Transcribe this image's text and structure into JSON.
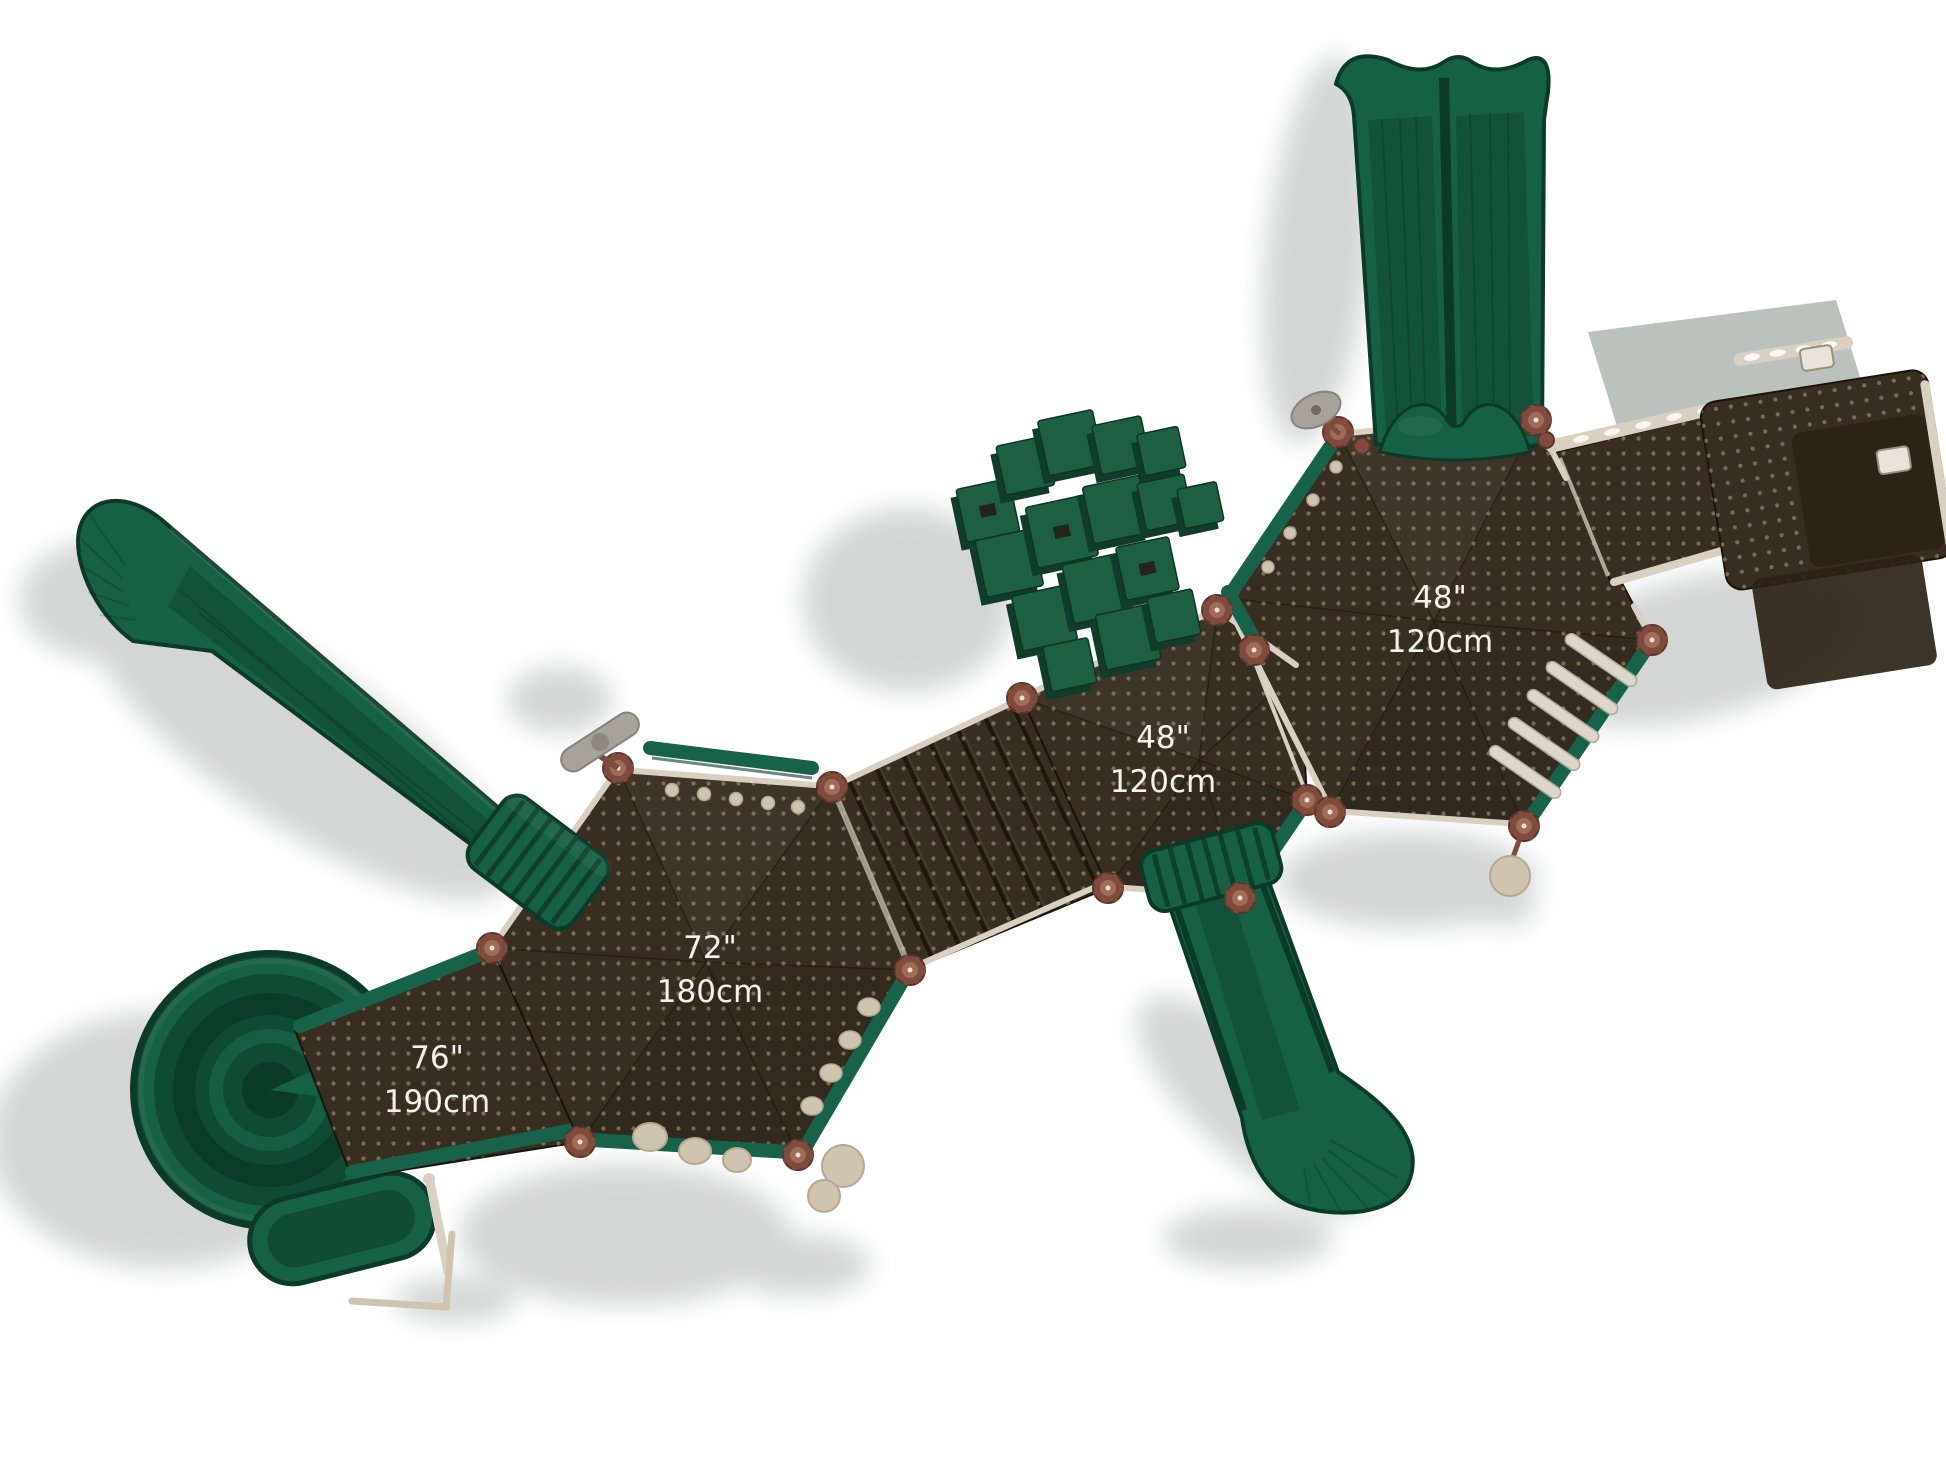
{
  "dimension_labels": [
    {
      "id": "deck-48-right",
      "inches": "48\"",
      "cm": "120cm"
    },
    {
      "id": "deck-48-middle",
      "inches": "48\"",
      "cm": "120cm"
    },
    {
      "id": "deck-72",
      "inches": "72\"",
      "cm": "180cm"
    },
    {
      "id": "ramp-76",
      "inches": "76\"",
      "cm": "190cm"
    }
  ],
  "colors": {
    "background": "#ffffff",
    "shadow": "#c8cccb",
    "slide_green": "#166045",
    "slide_green_dark": "#0f4a33",
    "slide_green_deep": "#0b3a28",
    "rail_green": "#17634a",
    "wall_green": "#1d5f41",
    "wall_green_dark": "#113c2a",
    "deck_brown": "#372e21",
    "deck_brown_dark": "#2b2316",
    "deck_dot": "#a59477",
    "tan_rail": "#d9d0c2",
    "copper": "#7e4b3d",
    "copper_light": "#a06b59",
    "beige_part": "#cfc4b0",
    "gray_part": "#a7a29a",
    "slab_gray": "#b7beb8",
    "label_text": "#f4f1ea"
  }
}
